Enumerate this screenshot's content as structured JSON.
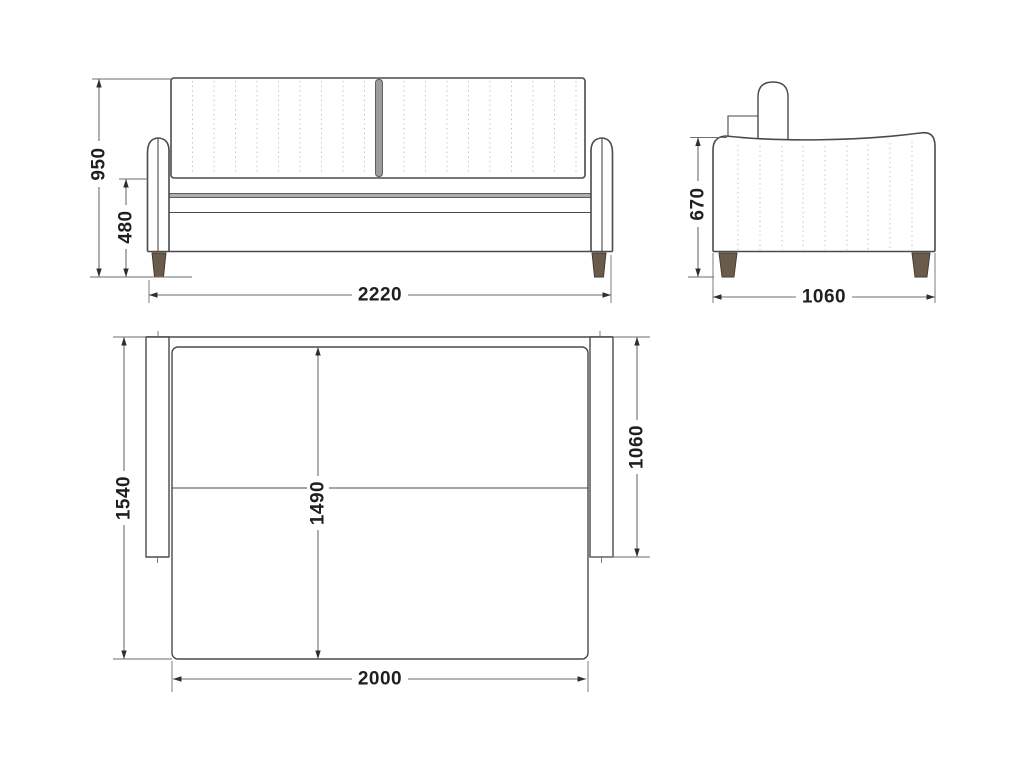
{
  "drawing": {
    "type": "sofa-bed technical dimension drawing, three orthographic views",
    "front_view": {
      "overall_height": "950",
      "seat_height": "480",
      "overall_width": "2220"
    },
    "side_view": {
      "armrest_height": "670",
      "overall_depth": "1060"
    },
    "top_view": {
      "unfolded_depth": "1540",
      "sleeping_length": "1490",
      "sofa_depth": "1060",
      "sleeping_width": "2000"
    },
    "colors": {
      "outline": "#4a4a4a",
      "dimension": "#6e6e6e",
      "arrow": "#2e2e2e",
      "stitch": "#c6c6c6",
      "leg_wood": "#6b5b4d",
      "text": "#1f1f1f",
      "background": "#ffffff"
    }
  }
}
